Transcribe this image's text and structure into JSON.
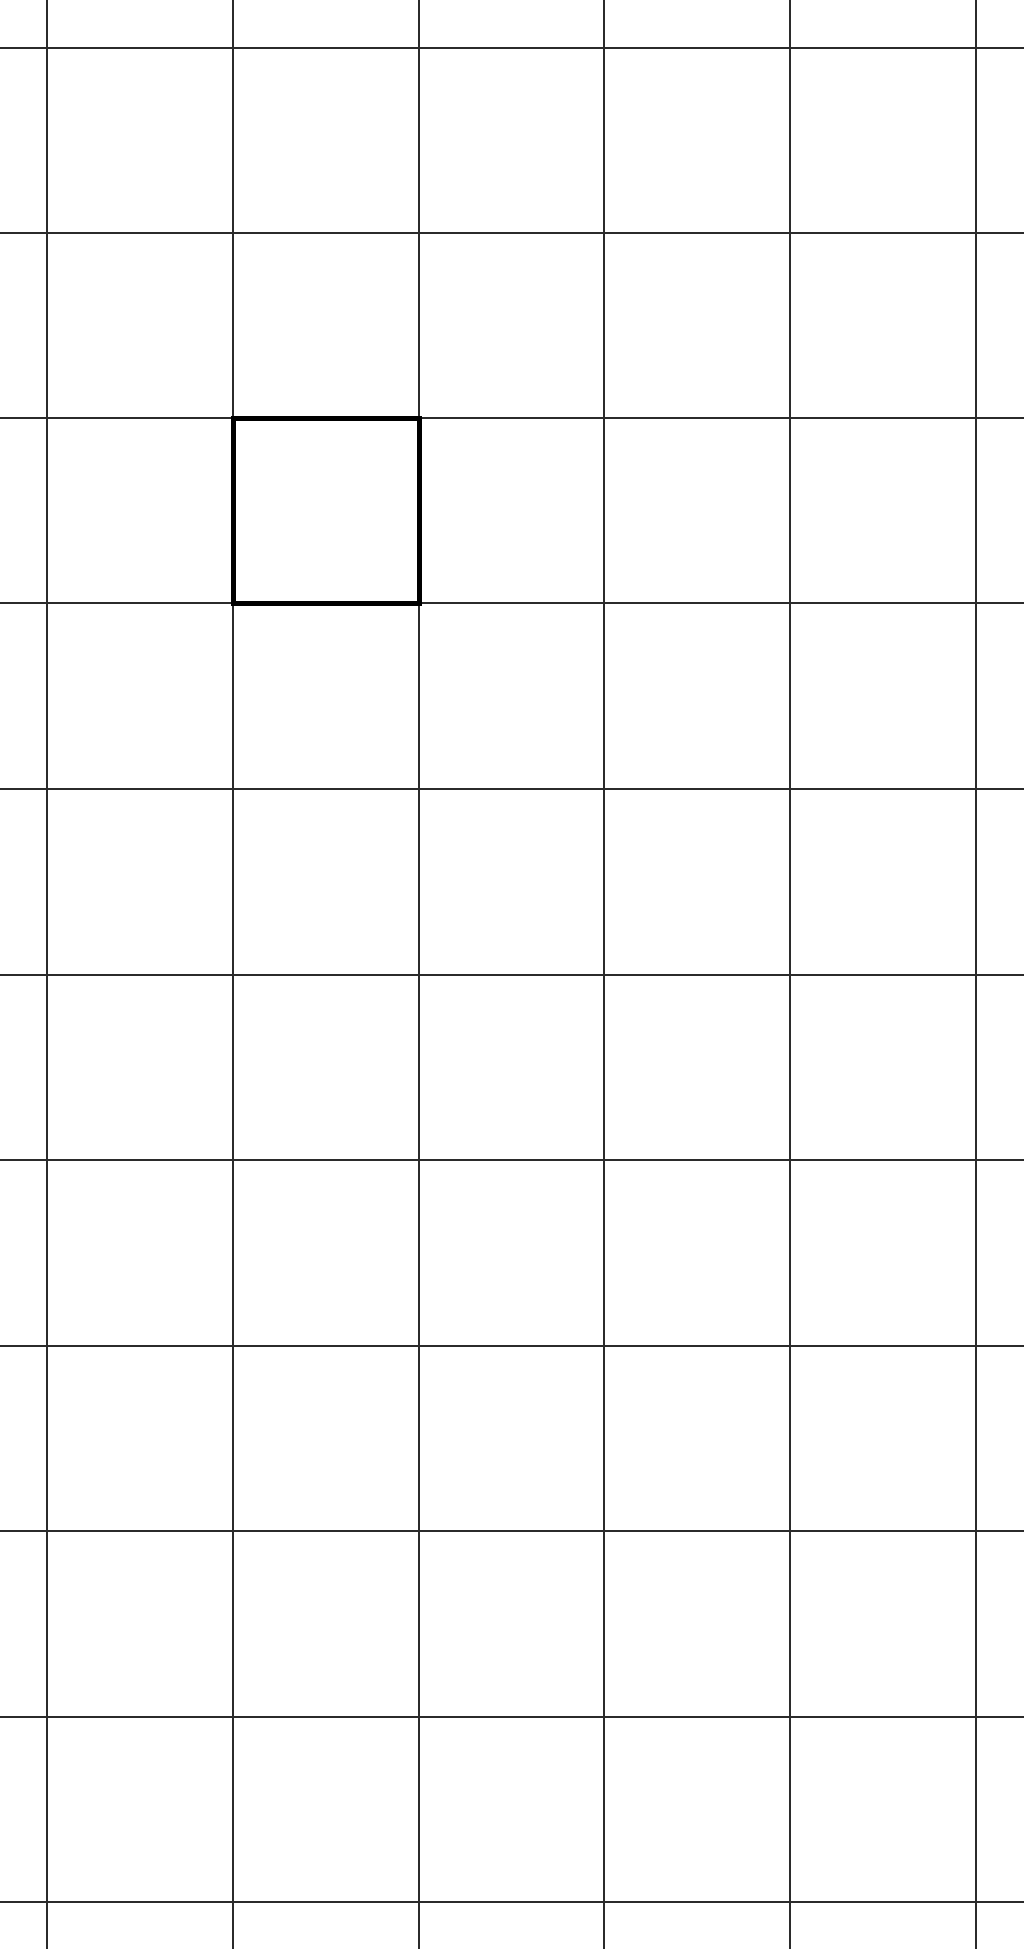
{
  "canvas": {
    "width": 1024,
    "height": 1949,
    "background_color": "#ffffff"
  },
  "grid": {
    "line_color": "#2b2b2b",
    "line_thickness": 2,
    "cell_size": 186,
    "vertical_lines_x": [
      47,
      233,
      419,
      604,
      790,
      976
    ],
    "horizontal_lines_y": [
      48,
      233,
      418,
      603,
      789,
      975,
      1160,
      1346,
      1531,
      1717,
      1902
    ],
    "visible_column_regions": 7,
    "visible_row_regions": 12
  },
  "highlighted_cell": {
    "column_index": 2,
    "row_index": 3,
    "bounds": {
      "left": 233,
      "top": 418,
      "right": 419,
      "bottom": 603
    },
    "border_color": "#000000",
    "border_thickness": 5
  }
}
